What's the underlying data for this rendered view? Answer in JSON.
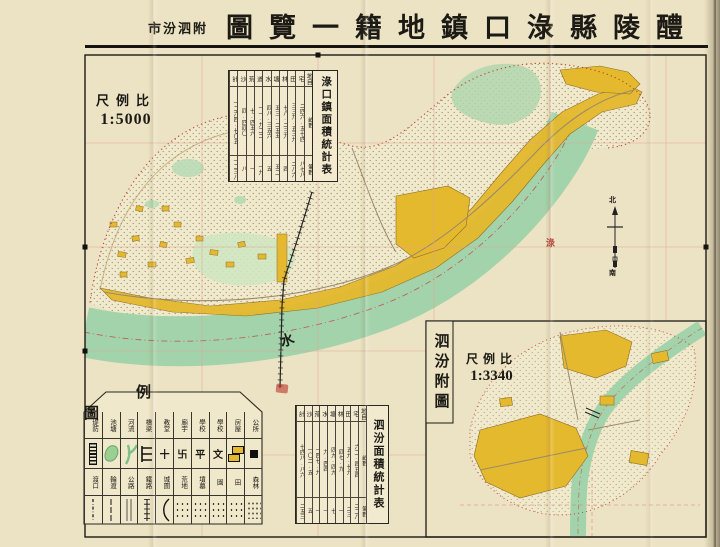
{
  "title": {
    "reading": "醴陵縣淥口鎮地籍一覽圖 附泗汾市",
    "main_display": "圖覽一籍地鎮口淥縣陵醴",
    "prefix_display": "市汾泗附"
  },
  "scale_main": {
    "label_display": "尺例比",
    "value": "1:5000"
  },
  "inset": {
    "title_vertical": "泗汾附圖",
    "scale_label_display": "尺例比",
    "scale_value": "1:3340"
  },
  "stats_main": {
    "title": "淥口鎮面積統計表",
    "unit_col": {
      "h": "地目",
      "a": "畝數",
      "c": "筆數"
    },
    "cols": [
      {
        "h": "宅",
        "a": "二四六.五七四",
        "c": "八七八"
      },
      {
        "h": "田",
        "a": "三三九.五三九",
        "c": "二八六"
      },
      {
        "h": "林",
        "a": "七八.二三九",
        "c": "四"
      },
      {
        "h": "塘",
        "a": "五三.二五五",
        "c": "五二"
      },
      {
        "h": "水",
        "a": "四八.三五六",
        "c": "五"
      },
      {
        "h": "道",
        "a": "一一.九二二",
        "c": "一九"
      },
      {
        "h": "荒",
        "a": "七.四五六",
        "c": "一"
      },
      {
        "h": "沙",
        "a": "四.四四〇",
        "c": "八"
      },
      {
        "h": "計",
        "a": "一二六四.七〇五",
        "c": "一二三八"
      }
    ]
  },
  "stats_inset": {
    "title": "泗汾面積統計表",
    "unit_col": {
      "h": "地目",
      "a": "畝數",
      "c": "筆數"
    },
    "cols": [
      {
        "h": "宅",
        "a": "六二.四五四",
        "c": "二二八"
      },
      {
        "h": "田",
        "a": "五九.七九",
        "c": "二三"
      },
      {
        "h": "林",
        "a": "四七.九",
        "c": "一"
      },
      {
        "h": "塘",
        "a": "四九.四九",
        "c": "七"
      },
      {
        "h": "水",
        "a": "九.四四",
        "c": "一"
      },
      {
        "h": "荒",
        "a": "一四七.九",
        "c": "一"
      },
      {
        "h": "沙",
        "a": "一〇二.五",
        "c": "五"
      },
      {
        "h": "計",
        "a": "七四八.八六",
        "c": "二五三"
      }
    ]
  },
  "legend": {
    "title_display": "例圖",
    "row1": [
      {
        "label": "堤防"
      },
      {
        "label": "池塘"
      },
      {
        "label": "河流"
      },
      {
        "label": "橋梁"
      },
      {
        "label": "教堂",
        "char": "十"
      },
      {
        "label": "廟宇",
        "char": "卐"
      },
      {
        "label": "學校",
        "char": "平"
      },
      {
        "label": "學校",
        "char": "文"
      },
      {
        "label": "房屋"
      },
      {
        "label": "公所"
      }
    ],
    "row2": [
      {
        "label": "渡口"
      },
      {
        "label": "輪渡"
      },
      {
        "label": "公路"
      },
      {
        "label": "鐵路"
      },
      {
        "label": "城圍"
      },
      {
        "label": "荒地"
      },
      {
        "label": "墳墓"
      },
      {
        "label": "園"
      },
      {
        "label": "田"
      },
      {
        "label": "森林"
      }
    ]
  },
  "map_labels": {
    "river_char_upper": "淥",
    "river_char_lower": "水"
  },
  "compass": {
    "north": "北",
    "south": "南"
  },
  "colors": {
    "built_up": "#e5b92e",
    "water": "#a3d3ab",
    "grid_red": "#e0a191",
    "boundary_red": "#c23b2e",
    "paper": "#ece3c4"
  }
}
